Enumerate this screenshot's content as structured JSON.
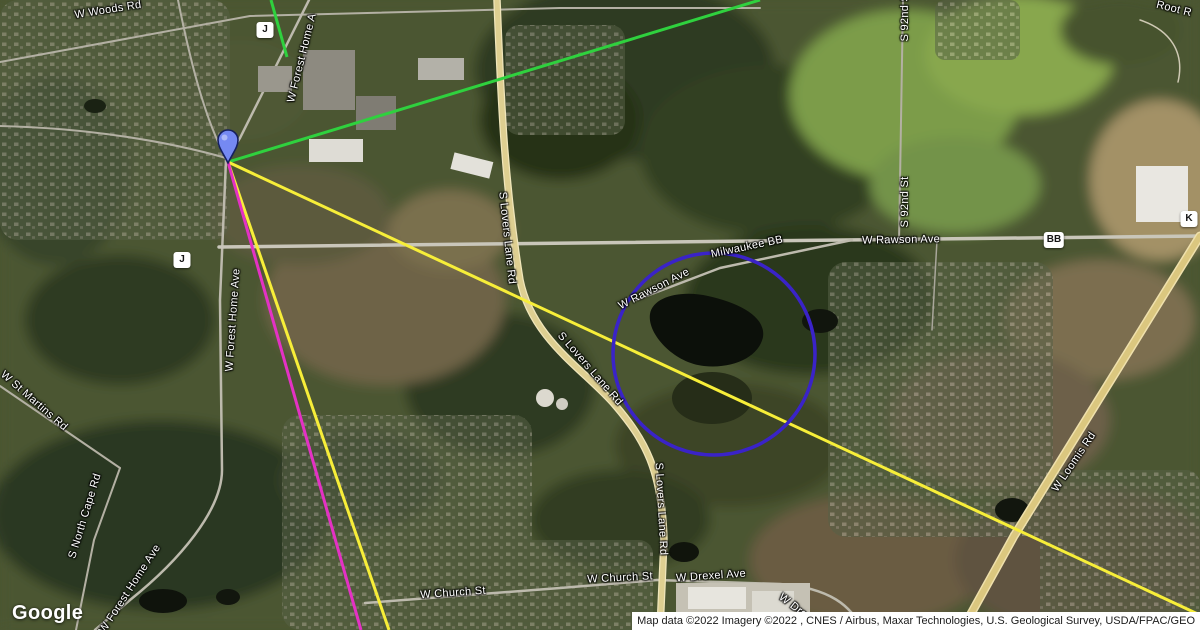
{
  "logo_text": "Google",
  "attribution": "Map data ©2022 Imagery ©2022 , CNES / Airbus, Maxar Technologies, U.S. Geological Survey, USDA/FPAC/GEO",
  "road_labels": [
    {
      "text": "W Woods Rd"
    },
    {
      "text": "W Forest Home A"
    },
    {
      "text": "W Forest Home Ave"
    },
    {
      "text": "W St Martins Rd"
    },
    {
      "text": "S North Cape Rd"
    },
    {
      "text": "W Forest Home Ave"
    },
    {
      "text": "S Lovers Lane Rd"
    },
    {
      "text": "S Lovers Lane Rd"
    },
    {
      "text": "S Lovers Lane Rd"
    },
    {
      "text": "W Rawson Ave"
    },
    {
      "text": "W Rawson Ave"
    },
    {
      "text": "Milwaukee BB"
    },
    {
      "text": "S 92nd St"
    },
    {
      "text": "S 92nd St"
    },
    {
      "text": "Root R"
    },
    {
      "text": "W Loomis Rd"
    },
    {
      "text": "W Church St"
    },
    {
      "text": "W Church St"
    },
    {
      "text": "W Drexel Ave"
    },
    {
      "text": "W Dre"
    }
  ],
  "route_badges": [
    {
      "text": "J"
    },
    {
      "text": "J"
    },
    {
      "text": "BB"
    },
    {
      "text": "K"
    }
  ],
  "annotations": {
    "marker_icon": "blue-map-pin",
    "marker_fill": "#7589f2",
    "marker_stroke": "#16205e",
    "circle_color": "#3a23c8",
    "line_colors": {
      "green": "#2fd13e",
      "yellow": "#f7ee39",
      "magenta": "#e431c4"
    }
  }
}
